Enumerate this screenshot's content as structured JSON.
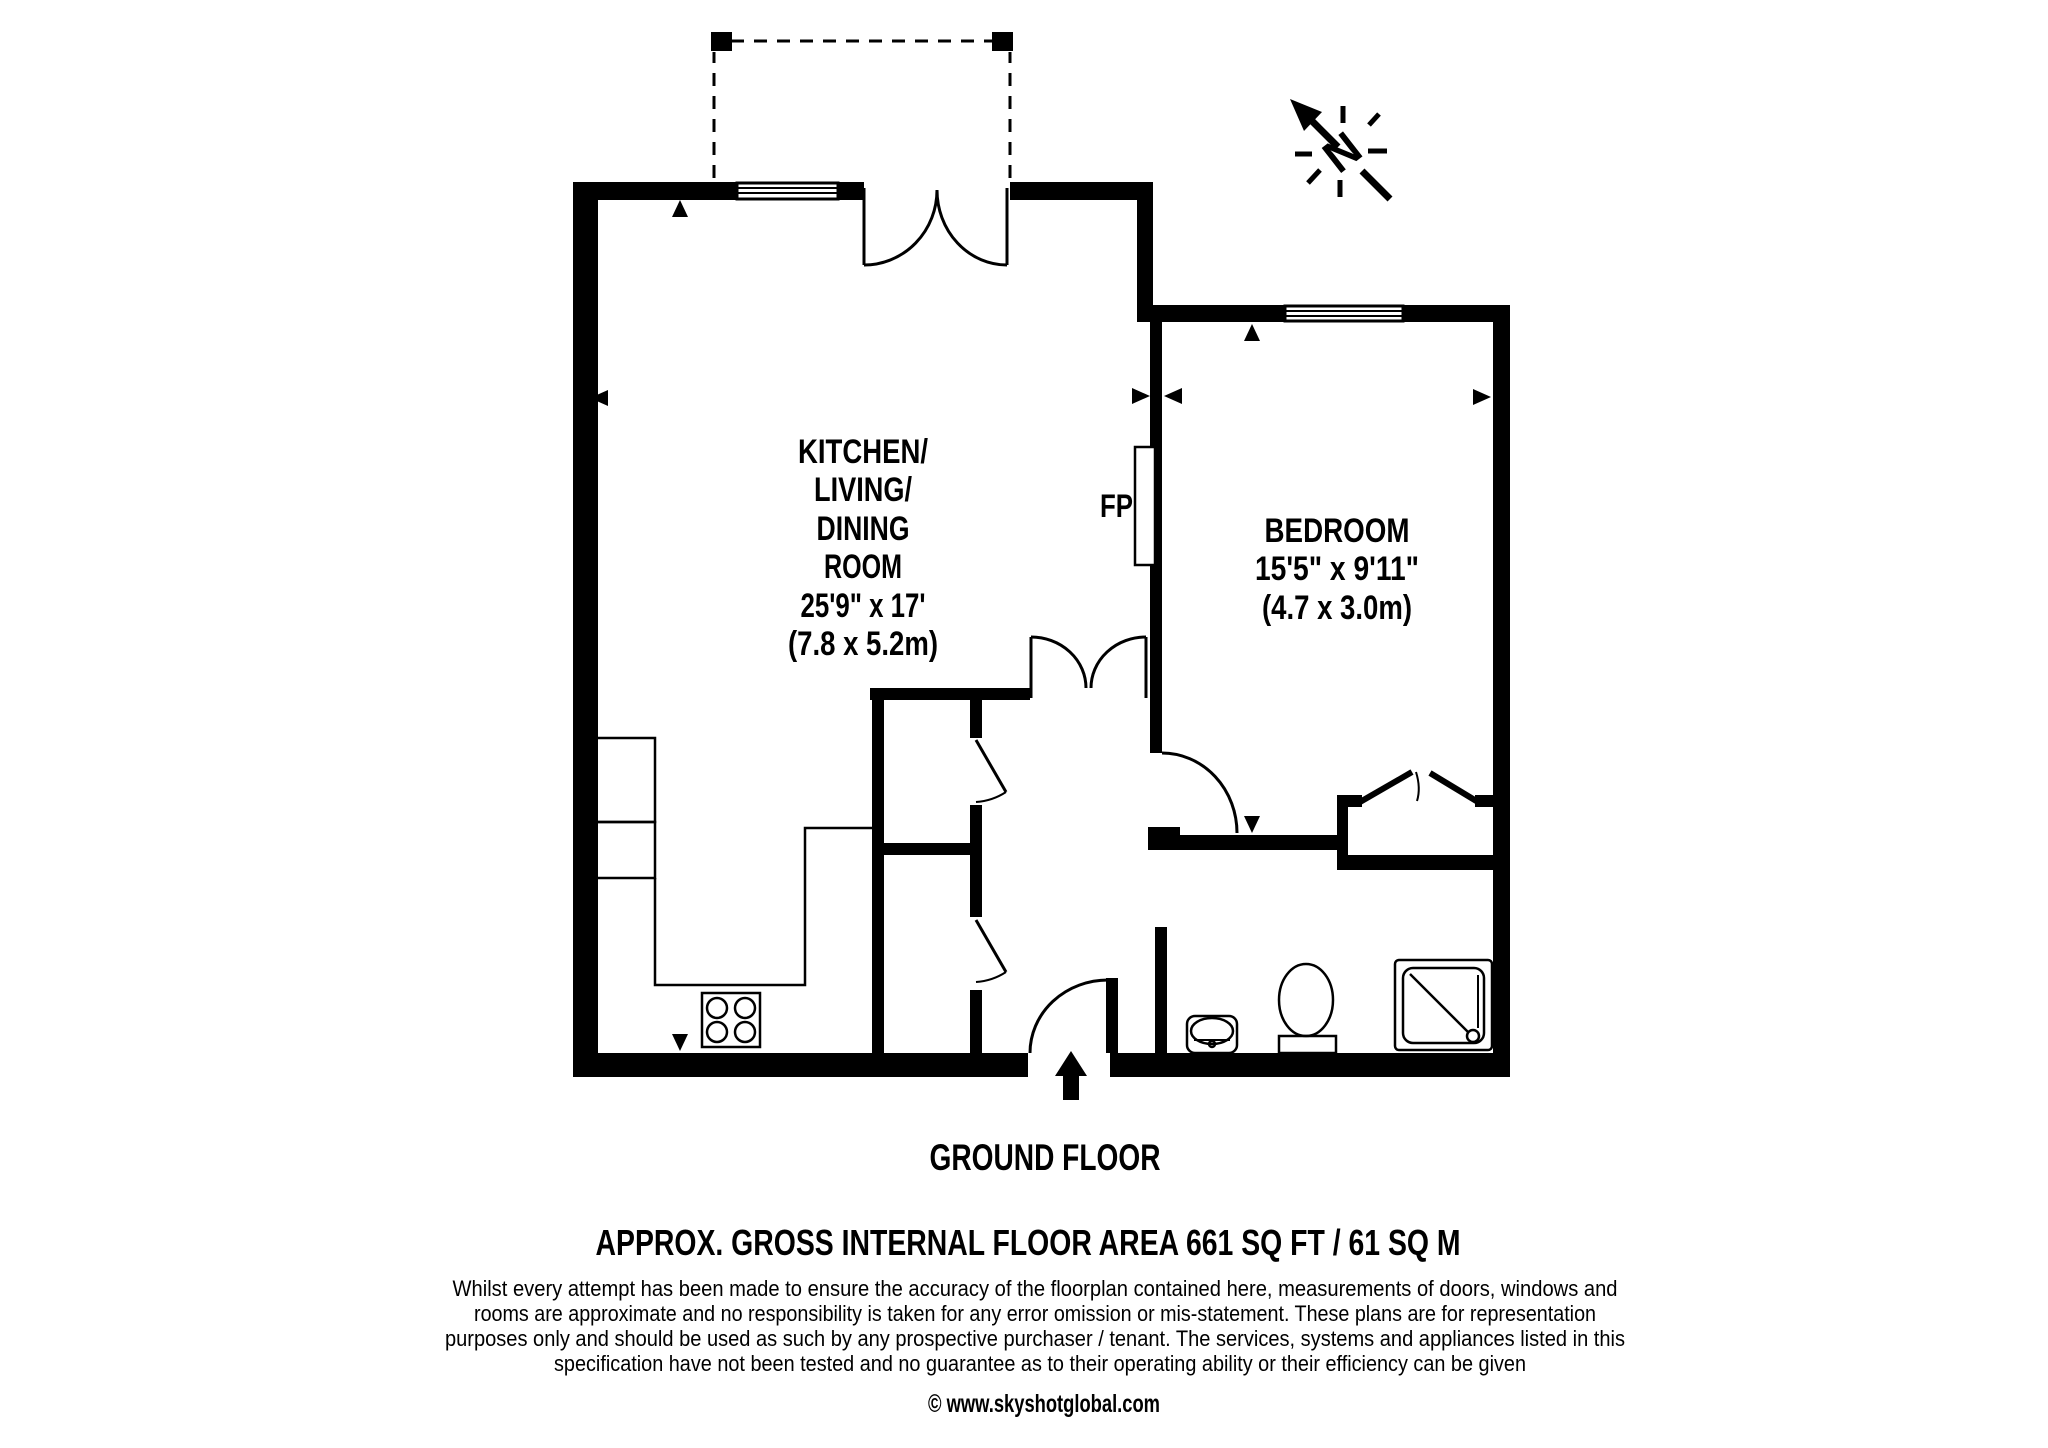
{
  "plan": {
    "compass_letter": "N",
    "fireplace_label": "FP",
    "rooms": {
      "living": {
        "name_lines": [
          "KITCHEN/",
          "LIVING/",
          "DINING",
          "ROOM"
        ],
        "dim_imperial": "25'9\" x 17'",
        "dim_metric": "(7.8 x 5.2m)"
      },
      "bedroom": {
        "name": "BEDROOM",
        "dim_imperial": "15'5\" x 9'11\"",
        "dim_metric": "(4.7 x 3.0m)"
      }
    },
    "floor_label": "GROUND FLOOR",
    "area_label": "APPROX. GROSS INTERNAL FLOOR AREA 661 SQ FT / 61 SQ M"
  },
  "footer": {
    "disclaimer_lines": [
      "Whilst every attempt has been made to ensure the accuracy of the floorplan contained here, measurements of doors, windows and",
      "rooms are approximate and no responsibility is taken for any error omission or mis-statement. These plans are for representation",
      "purposes only and should  be used as such by any prospective purchaser / tenant. The services, systems and appliances listed in this",
      "specification have not been tested and no guarantee as to their operating ability or their efficiency can be given"
    ],
    "copyright": "© www.skyshotglobal.com"
  },
  "colors": {
    "wall": "#000000",
    "background": "#ffffff"
  }
}
